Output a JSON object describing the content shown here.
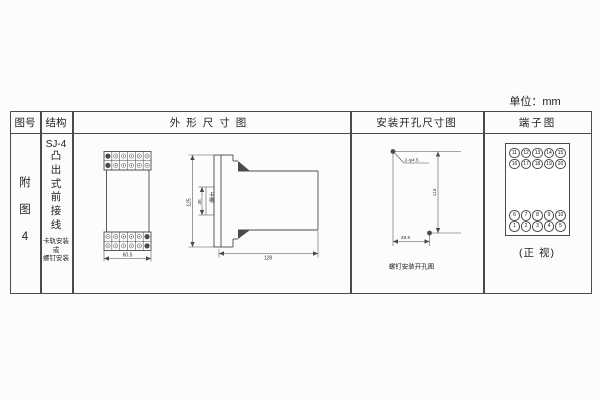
{
  "unit_label": "单位：mm",
  "table_headers": {
    "col1": "图号",
    "col2": "结构",
    "col3": "外形尺寸图",
    "col4": "安装开孔尺寸图",
    "col5": "端子图"
  },
  "figure_no": "附\n图\n4",
  "structure": {
    "model": "SJ-4",
    "type": "凸\n出\n式\n前\n接\n线",
    "mount_note": "卡轨安装\n或\n螺钉安装"
  },
  "outline_dims": {
    "width": "60.5",
    "height": "125",
    "slot": "35",
    "slot_label": "卡槽",
    "depth": "128"
  },
  "mounting": {
    "holes": "2-φ4.5",
    "height": "113",
    "width": "48.5",
    "caption": "螺钉安装开孔图"
  },
  "terminals": {
    "top_rows": [
      [
        "11",
        "12",
        "13",
        "14",
        "15"
      ],
      [
        "16",
        "17",
        "18",
        "19",
        "20"
      ]
    ],
    "bottom_rows": [
      [
        "6",
        "7",
        "8",
        "9",
        "10"
      ],
      [
        "1",
        "2",
        "3",
        "4",
        "5"
      ]
    ],
    "caption": "(正 视)"
  },
  "colors": {
    "line": "#4a4a4a",
    "text": "#222222"
  }
}
